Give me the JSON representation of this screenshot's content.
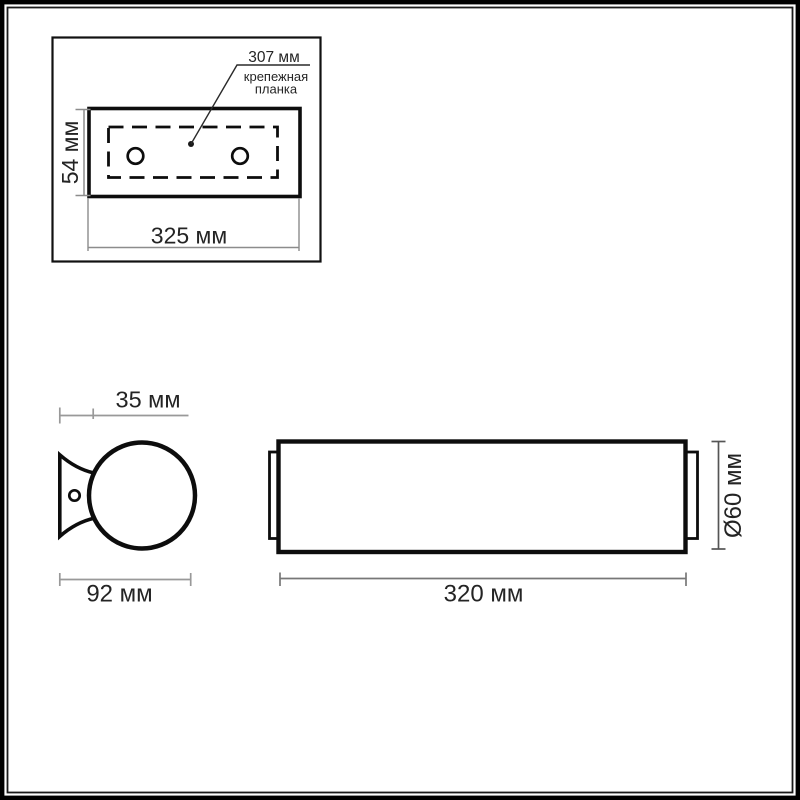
{
  "drawing": {
    "detail_box": {
      "plate_span_label": "307 мм",
      "plate_name_line1": "крепежная",
      "plate_name_line2": "планка",
      "plate_height_label": "54 мм",
      "plate_width_label": "325 мм"
    },
    "side_view": {
      "bracket_depth_label": "35 мм",
      "overall_depth_label": "92 мм"
    },
    "front_view": {
      "length_label": "320 мм",
      "diameter_label": "Ø60 мм"
    },
    "colors": {
      "shape_line": "#0d0d0d",
      "dimension_line": "#8c8c8c",
      "dimension_line_dark": "#555555",
      "text": "#242424"
    }
  }
}
